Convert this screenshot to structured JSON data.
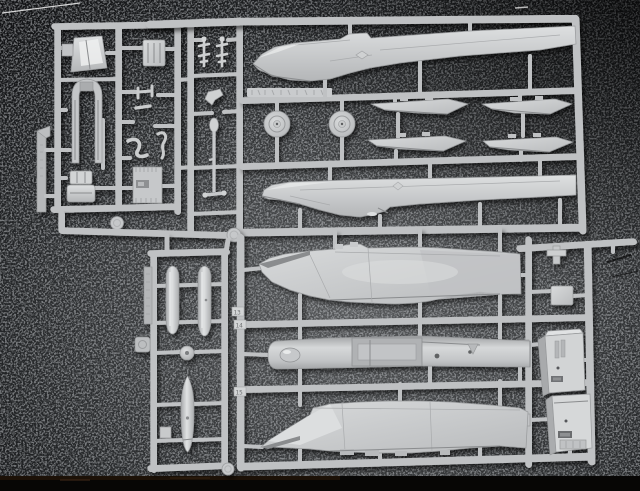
{
  "image": {
    "type": "photograph",
    "subject": "Injection-molded polystyrene sprues of a jet fighter model kit laid on a dark speckled surface",
    "plastic_color": "#c6c8ca",
    "plastic_highlight": "#e8eaea",
    "background_color": "#3a3c3e",
    "background_corner_color": "#121315",
    "bottom_edge_color": "#070605"
  },
  "sprues": {
    "top_left": {
      "name": "cockpit and detail parts sprue",
      "parts": [
        "windscreen",
        "cockpit tub",
        "instrument panel",
        "bracket parts",
        "ejection seat halves",
        "louvered panel",
        "runner tag"
      ]
    },
    "top_center": {
      "name": "small parts column",
      "parts": [
        "antenna sprig",
        "antenna sprig",
        "chevron bracket",
        "landing gear strut"
      ]
    },
    "top_right": {
      "name": "fuselage sprue",
      "parts": [
        "upper fuselage half",
        "main wheel",
        "main wheel",
        "stabilizer half",
        "stabilizer half",
        "stabilizer half",
        "stabilizer half",
        "lower fuselage half"
      ],
      "molded_text_legible": false
    },
    "bottom_left": {
      "name": "external stores sprue",
      "parts": [
        "drop tank",
        "drop tank",
        "hub ball",
        "centerline store",
        "small panel",
        "embossed runner tag"
      ],
      "molded_text_legible": false
    },
    "bottom_right": {
      "name": "wing and intake sprue",
      "parts": [
        "upper wing piece",
        "intake trunk",
        "lower wing piece",
        "square panel",
        "intake duct box",
        "intake duct box"
      ],
      "gate_tags": [
        "13",
        "14",
        "15"
      ]
    }
  }
}
